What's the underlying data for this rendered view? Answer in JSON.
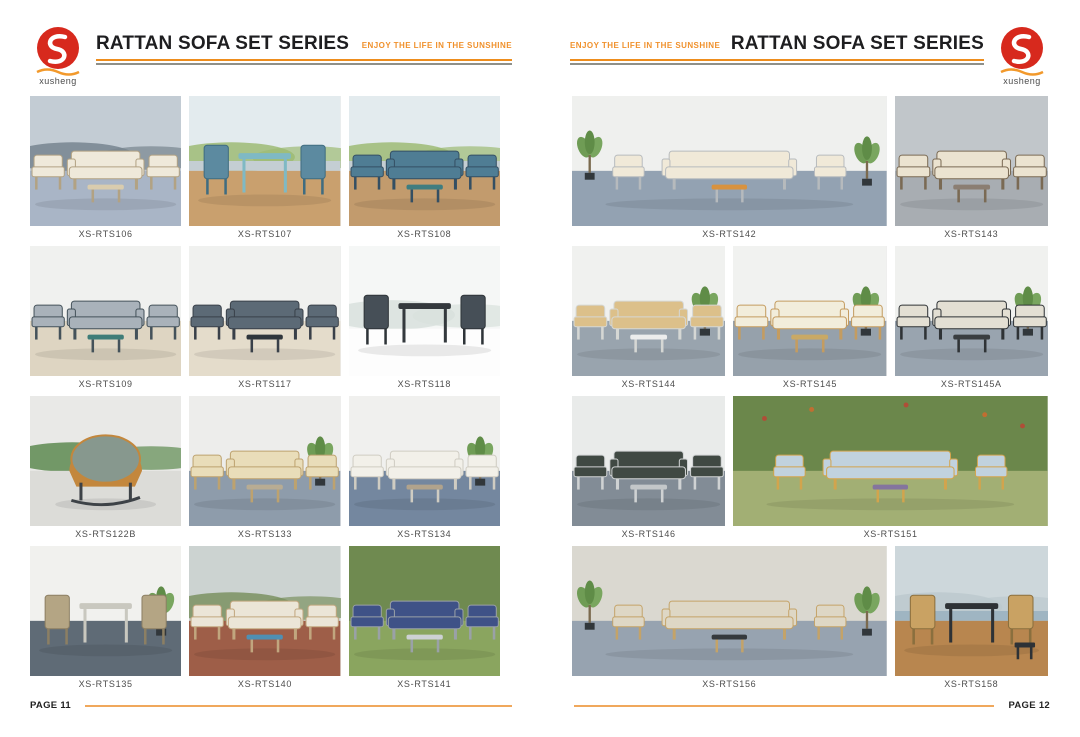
{
  "brand": {
    "name": "xusheng",
    "logo_red": "#d7291d",
    "logo_wave_orange": "#f2992b"
  },
  "header": {
    "title": "RATTAN SOFA SET SERIES",
    "tagline": "ENJOY THE LIFE IN THE SUNSHINE",
    "rule_orange": "#ee8d1d",
    "rule_gray": "#8f9089"
  },
  "footer": {
    "rule_color": "#f0a85c"
  },
  "pages": [
    {
      "number_label": "PAGE 11",
      "products": [
        {
          "model": "XS-RTS106",
          "span": 1,
          "scene": {
            "wall": "#c3ccd4",
            "band": "#77848f",
            "floor": "#a9b5c6",
            "c": "#efe9da",
            "f": "#b2a283",
            "t": "#d9ccae"
          }
        },
        {
          "model": "XS-RTS107",
          "span": 1,
          "scene": {
            "wall": "#e3ebee",
            "band": "#9dbb74",
            "water": "#c4ced3",
            "floor": "#c9a06e",
            "c": "#5c8aa0",
            "f": "#3f6c80",
            "t": "#7fb9c4",
            "kind": "dining"
          }
        },
        {
          "model": "XS-RTS108",
          "span": 1,
          "scene": {
            "wall": "#e3ebee",
            "band": "#9dbb74",
            "water": "#c4ced3",
            "floor": "#c29b6d",
            "c": "#4f7d94",
            "f": "#344f63",
            "t": "#3e7d80"
          }
        },
        {
          "model": "XS-RTS109",
          "span": 1,
          "scene": {
            "wall": "#f0f1ef",
            "floor": "#ded5c2",
            "c": "#a9b2ba",
            "f": "#44525a",
            "t": "#3f7d78"
          }
        },
        {
          "model": "XS-RTS117",
          "span": 1,
          "scene": {
            "wall": "#f0f1ef",
            "floor": "#e4dccb",
            "c": "#5c6a76",
            "f": "#394049",
            "t": "#2f363c"
          }
        },
        {
          "model": "XS-RTS118",
          "span": 1,
          "scene": {
            "wall": "#f5f7f6",
            "band": "#d8e1dd",
            "floor": "#fdfdfd",
            "c": "#464f57",
            "f": "#2e3438",
            "t": "#34393d",
            "kind": "dining",
            "h": 84
          }
        },
        {
          "model": "XS-RTS122B",
          "span": 1,
          "scene": {
            "wall": "#e9e9e7",
            "band": "#5d8a50",
            "floor": "#dcdcd8",
            "c": "#87988e",
            "f": "#c3873d",
            "t": "#3d4247",
            "kind": "single"
          }
        },
        {
          "model": "XS-RTS133",
          "span": 1,
          "scene": {
            "wall": "#ededeb",
            "floor": "#8e9cab",
            "c": "#e9ddb9",
            "f": "#bda26f",
            "t": "#b8ac93",
            "plant": true
          }
        },
        {
          "model": "XS-RTS134",
          "span": 1,
          "scene": {
            "wall": "#f0f0ee",
            "floor": "#74879f",
            "c": "#f2f0e9",
            "f": "#cfccc2",
            "t": "#b1a38c",
            "plant": true
          }
        },
        {
          "model": "XS-RTS135",
          "span": 1,
          "scene": {
            "wall": "#f1f1ee",
            "floor": "#5f6b76",
            "c": "#b4a584",
            "f": "#8c7f63",
            "t": "#c9c8bf",
            "kind": "dining",
            "plant": true
          }
        },
        {
          "model": "XS-RTS140",
          "span": 1,
          "scene": {
            "wall": "#ccd3d1",
            "band": "#7a9161",
            "floor": "#9e5e48",
            "c": "#ebe5d7",
            "f": "#c1a67e",
            "t": "#4f8fb3"
          }
        },
        {
          "model": "XS-RTS141",
          "span": 1,
          "scene": {
            "wall": "#6f8a50",
            "floor": "#8aa55f",
            "c": "#3f5287",
            "f": "#9aa1a7",
            "t": "#cdd1d4"
          }
        }
      ]
    },
    {
      "number_label": "PAGE 12",
      "products": [
        {
          "model": "XS-RTS142",
          "span": 2,
          "scene": {
            "wall": "#eff0ee",
            "floor": "#93a2b2",
            "c": "#f0e9d8",
            "f": "#b6babd",
            "t": "#d8923e",
            "plant": true
          }
        },
        {
          "model": "XS-RTS143",
          "span": 1,
          "scene": {
            "wall": "#c1c6ca",
            "floor": "#a8adb2",
            "c": "#ebe3d0",
            "f": "#7a6a54",
            "t": "#8b7e72"
          }
        },
        {
          "model": "XS-RTS144",
          "span": 1,
          "scene": {
            "wall": "#f0f1ef",
            "floor": "#99a4ae",
            "c": "#dcc08a",
            "f": "#d5d7d4",
            "t": "#eceded",
            "plant": true
          }
        },
        {
          "model": "XS-RTS145",
          "span": 1,
          "scene": {
            "wall": "#f1f2f0",
            "floor": "#96a1ab",
            "c": "#f2eddb",
            "f": "#c49c60",
            "t": "#c9a965",
            "plant": true
          }
        },
        {
          "model": "XS-RTS145A",
          "span": 1,
          "scene": {
            "wall": "#f0f1ef",
            "floor": "#99a4af",
            "c": "#e3dfd3",
            "f": "#2f3336",
            "t": "#3a3e41",
            "plant": true
          }
        },
        {
          "model": "XS-RTS146",
          "span": 1,
          "scene": {
            "wall": "#e9ebea",
            "floor": "#828c96",
            "c": "#404943",
            "f": "#cfd2d3",
            "t": "#c3c7c9"
          }
        },
        {
          "model": "XS-RTS151",
          "span": 2,
          "scene": {
            "wall": "#6b874b",
            "floor": "#a2af74",
            "c": "#c1d2de",
            "f": "#d2a44d",
            "t": "#84759e",
            "flowers": true
          }
        },
        {
          "model": "XS-RTS156",
          "span": 2,
          "scene": {
            "wall": "#dad8d0",
            "floor": "#97a3b0",
            "c": "#ded7c5",
            "f": "#c4a368",
            "t": "#35393d",
            "plant": true
          }
        },
        {
          "model": "XS-RTS158",
          "span": 1,
          "scene": {
            "wall": "#cdd7db",
            "band": "#bcc9ce",
            "water": "#9fb5c2",
            "floor": "#b8864f",
            "c": "#c9a263",
            "f": "#8a6f3e",
            "t": "#2e3236",
            "kind": "dining",
            "stool": true
          }
        }
      ]
    }
  ]
}
